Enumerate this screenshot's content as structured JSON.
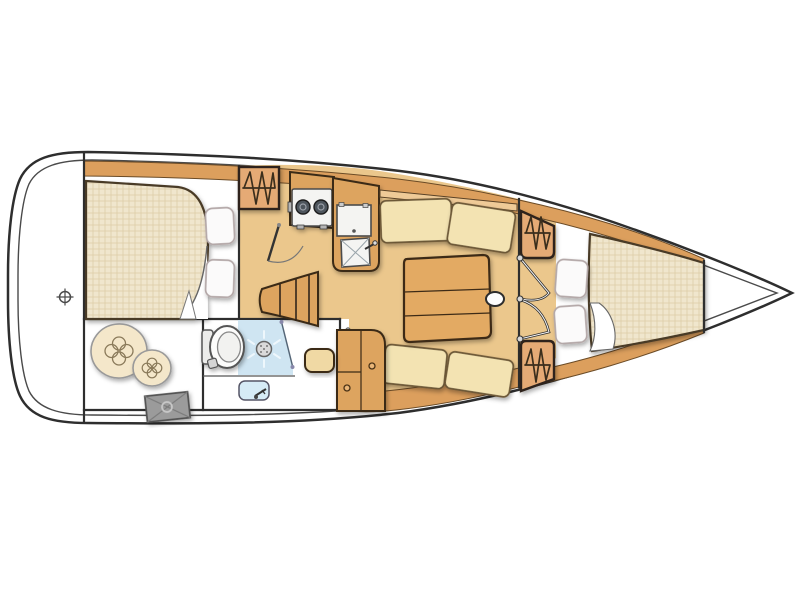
{
  "diagram": {
    "kind": "sailboat-interior-floor-plan",
    "orientation": "bow-right-stern-left"
  },
  "colors": {
    "hull_outline": "#2e2e2e",
    "deck_line": "#4a4a4a",
    "deck_white": "#ffffff",
    "sole_wood": "#ebc78c",
    "trim_wood": "#dc9f5d",
    "furniture_wood": "#dda45f",
    "table_wood": "#e3aa63",
    "locker_wood": "#e5aa74",
    "cushion": "#f3e3b2",
    "shelf_wood": "#efca97",
    "mattress_base": "#f0e6cd",
    "mattress_grid": "#decca7",
    "pillow": "#fbfafa",
    "pillow_edge": "#b3a7a7",
    "shower_blue": "#cfe5f2",
    "sink_blue": "#d6ebf6",
    "fixture_white": "#f4f4f2",
    "stove_burner": "#4e545c",
    "hatch_gray": "#9b9b9b",
    "fender_beige": "#f4e7ca",
    "stool_cream": "#f0d9a4",
    "spray_white": "#eef7fc"
  },
  "components": [
    {
      "name": "hull",
      "items": [
        "outer-hull-line",
        "inner-deck-line"
      ]
    },
    {
      "name": "stern-deck",
      "items": [
        "center-mark"
      ]
    },
    {
      "name": "aft-cabin",
      "items": [
        "double-berth",
        "pillow",
        "pillow",
        "hanging-locker",
        "cabin-door"
      ]
    },
    {
      "name": "galley",
      "items": [
        "two-burner-stove",
        "worktop",
        "sink",
        "counter"
      ]
    },
    {
      "name": "companionway",
      "items": [
        "steps"
      ]
    },
    {
      "name": "head",
      "items": [
        "toilet",
        "shower",
        "shower-head",
        "washbasin",
        "faucet",
        "door"
      ]
    },
    {
      "name": "storage-locker",
      "items": [
        "fender",
        "fender",
        "access-hatch"
      ]
    },
    {
      "name": "salon",
      "items": [
        "starboard-settee",
        "port-settee",
        "folding-table",
        "mast",
        "stool",
        "cabinet"
      ]
    },
    {
      "name": "forward-cabin",
      "items": [
        "v-berth",
        "pillow",
        "pillow",
        "hanging-locker",
        "hanging-locker",
        "bifold-door"
      ]
    }
  ]
}
